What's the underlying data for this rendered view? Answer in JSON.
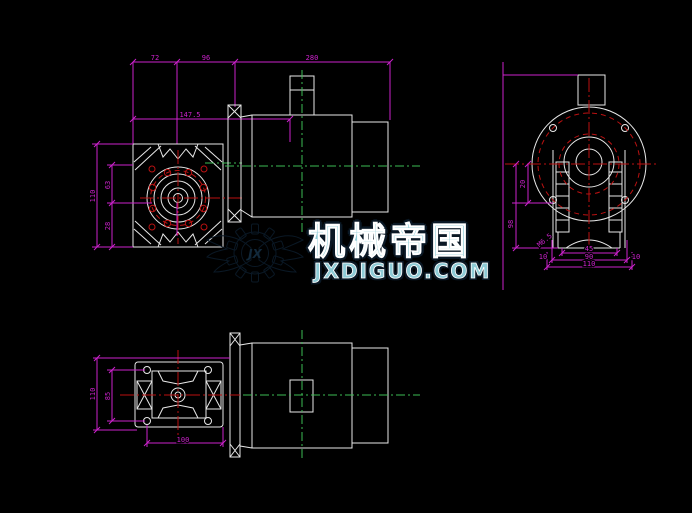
{
  "app": {
    "kind": "cad-drawing",
    "subject": "worm-gear-reducer-with-motor",
    "background": "#000000"
  },
  "colors": {
    "bg": "#000000",
    "outline": "#e8e8e8",
    "dim": "#cc22cc",
    "red": "#bb1111",
    "green": "#3dbb55",
    "wmfill": "#8ecbd6",
    "wmstroke": "#0a1825",
    "wminner": "#ffffff"
  },
  "watermark": {
    "monogram": "JX",
    "brand": "机械帝国",
    "site": "JXDIGUO.COM"
  },
  "dimensions": {
    "top": {
      "seg1": "72",
      "seg2": "96",
      "seg3": "280",
      "offset": "147.5"
    },
    "front": {
      "height": "110",
      "upper": "63",
      "lower": "28"
    },
    "rear": {
      "left_upper": "20",
      "left_lower": "98",
      "width1": "45",
      "width2": "90",
      "width3": "110",
      "side_left": "10",
      "side_right": "10",
      "thread_callout": "M6.5"
    },
    "plan": {
      "height": "110",
      "hole_span": "85",
      "hole_pitch": "100"
    }
  }
}
